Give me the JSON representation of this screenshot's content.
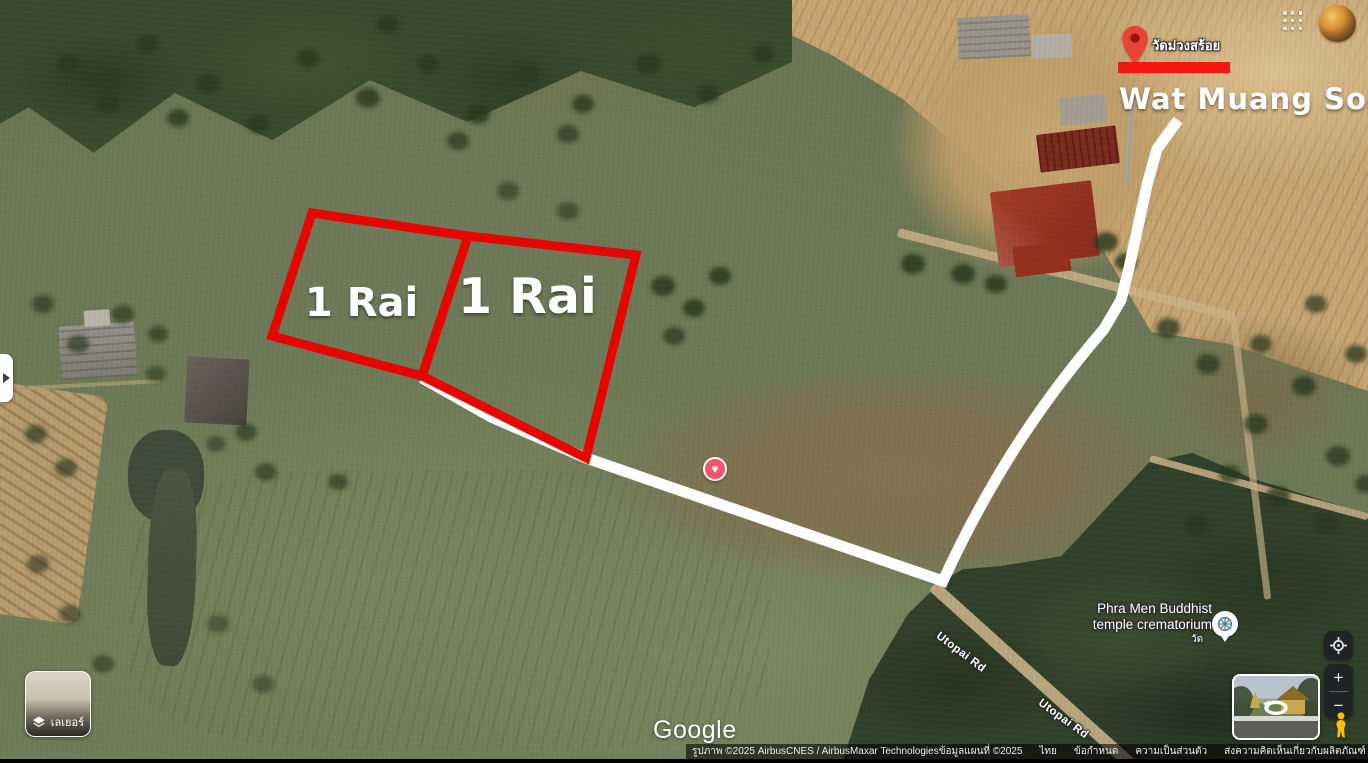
{
  "annotations": {
    "plot_left_label": "1 Rai",
    "plot_right_label": "1 Rai",
    "destination_thai": "วัดม่วงสร้อย",
    "destination_english": "Wat Muang Soi"
  },
  "map_labels": {
    "poi_line1": "Phra Men Buddhist",
    "poi_line2": "temple crematorium",
    "poi_sub": "วัด",
    "road_label_1": "Utopai Rd",
    "road_label_2": "Utopai Rd"
  },
  "controls": {
    "layers_label": "เลเยอร์",
    "zoom_in_label": "+",
    "zoom_out_label": "−"
  },
  "branding": {
    "logo": "Google"
  },
  "attribution": {
    "imagery_credit": "รูปภาพ ©2025 AirbusCNES / AirbusMaxar Technologiesข้อมูลแผนที่ ©2025",
    "links": [
      "ไทย",
      "ข้อกำหนด",
      "ความเป็นส่วนตัว",
      "ส่งความคิดเห็นเกี่ยวกับผลิตภัณฑ์"
    ],
    "scale_label": "20 ม."
  },
  "markers": {
    "saved_place_glyph": "♥"
  },
  "icons": {
    "apps_grid": "grid-3x3-dots",
    "avatar": "profile-photo",
    "panel_expand": "chevron-right",
    "layers": "layers-stack",
    "my_location": "crosshair-target",
    "pegman": "street-view-person",
    "destination_pin": "red-map-pin",
    "saved_heart": "heart-in-circle",
    "temple_wheel": "dharma-wheel",
    "street_view_rotate": "rotate-360-arrow"
  },
  "colors": {
    "plot_outline": "#e60500",
    "route_white": "#ffffff",
    "marker_bar_red": "#f2190a",
    "pin_red": "#ea4335",
    "heart_pink": "#f2546b",
    "wheel_teal": "#55828e",
    "pegman_yellow": "#fbbc04",
    "control_bg": "#202124"
  }
}
